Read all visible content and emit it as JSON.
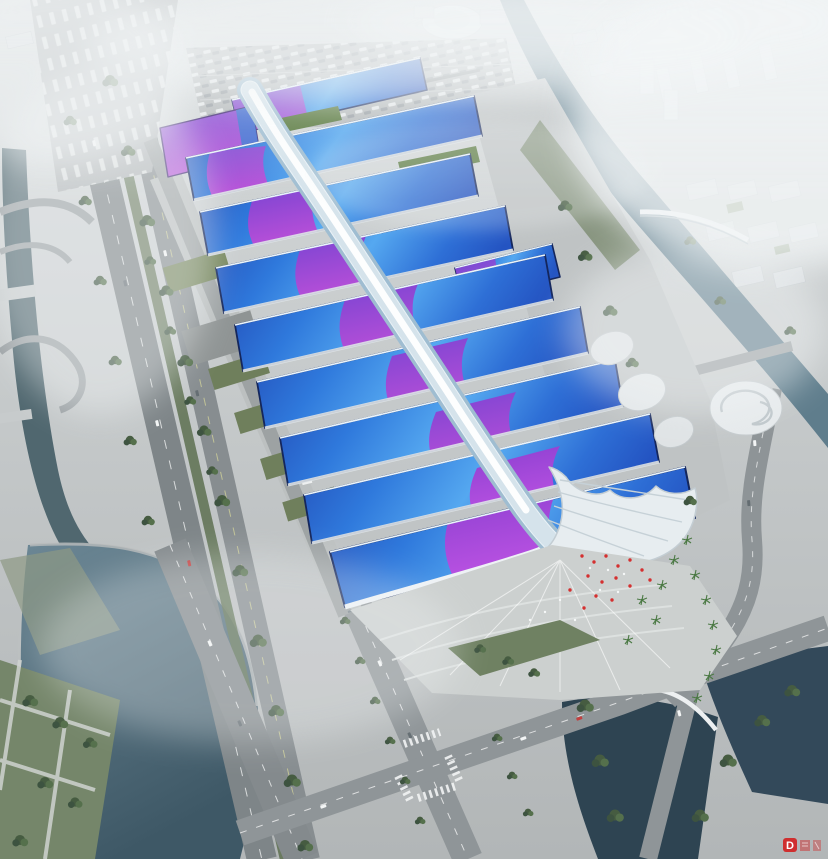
{
  "image": {
    "width": 828,
    "height": 859,
    "kind": "aerial architectural rendering (bird's-eye view)"
  },
  "scene": {
    "subject": "riverside exhibition and convention center complex",
    "features": [
      "parallel rows of long exhibition halls with wave-form blue roofs crossed by purple ribbon accents",
      "sinuous white quilted central canopy running the full length of the complex",
      "white shell-shaped entrance canopy with fan-shaped arrival plaza, palm trees and red flags",
      "elevated expressway and tree-lined avenues along the west side with service yards and truck parking",
      "large surface parking lot at the north end",
      "canal with pedestrian bridges on the east, lake and dark ponds on the south",
      "hazy white city skyline with a domed landmark in the distance"
    ]
  },
  "watermark": {
    "label": "D"
  },
  "colors": {
    "haze": "#f3f6f7",
    "city": "#d8dcdf",
    "ground_top": "#d6dadb",
    "ground_bottom": "#b2b6b7",
    "apron": "#bfc3c4",
    "road": "#8a9093",
    "water_canal": "#5f7d8c",
    "water_lake": "#54707f",
    "water_pond": "#2e4452",
    "river_west": "#50676f",
    "lawn": "#75866a",
    "tree": "#4a5f44",
    "garden": "#547538",
    "roof_deep": "#2148b4",
    "roof_blue": "#2f79dc",
    "roof_light": "#55a8f0",
    "wave_purple": "#7a44d2",
    "wave_purple_light": "#b84fd8",
    "wave_magenta": "#c054e4",
    "ribbon": "#e9f1f6",
    "ribbon_shade": "#9fbdd1",
    "shell": "#e7edf0",
    "flag_red": "#d43030",
    "watermark_red": "#cf2f2f"
  }
}
